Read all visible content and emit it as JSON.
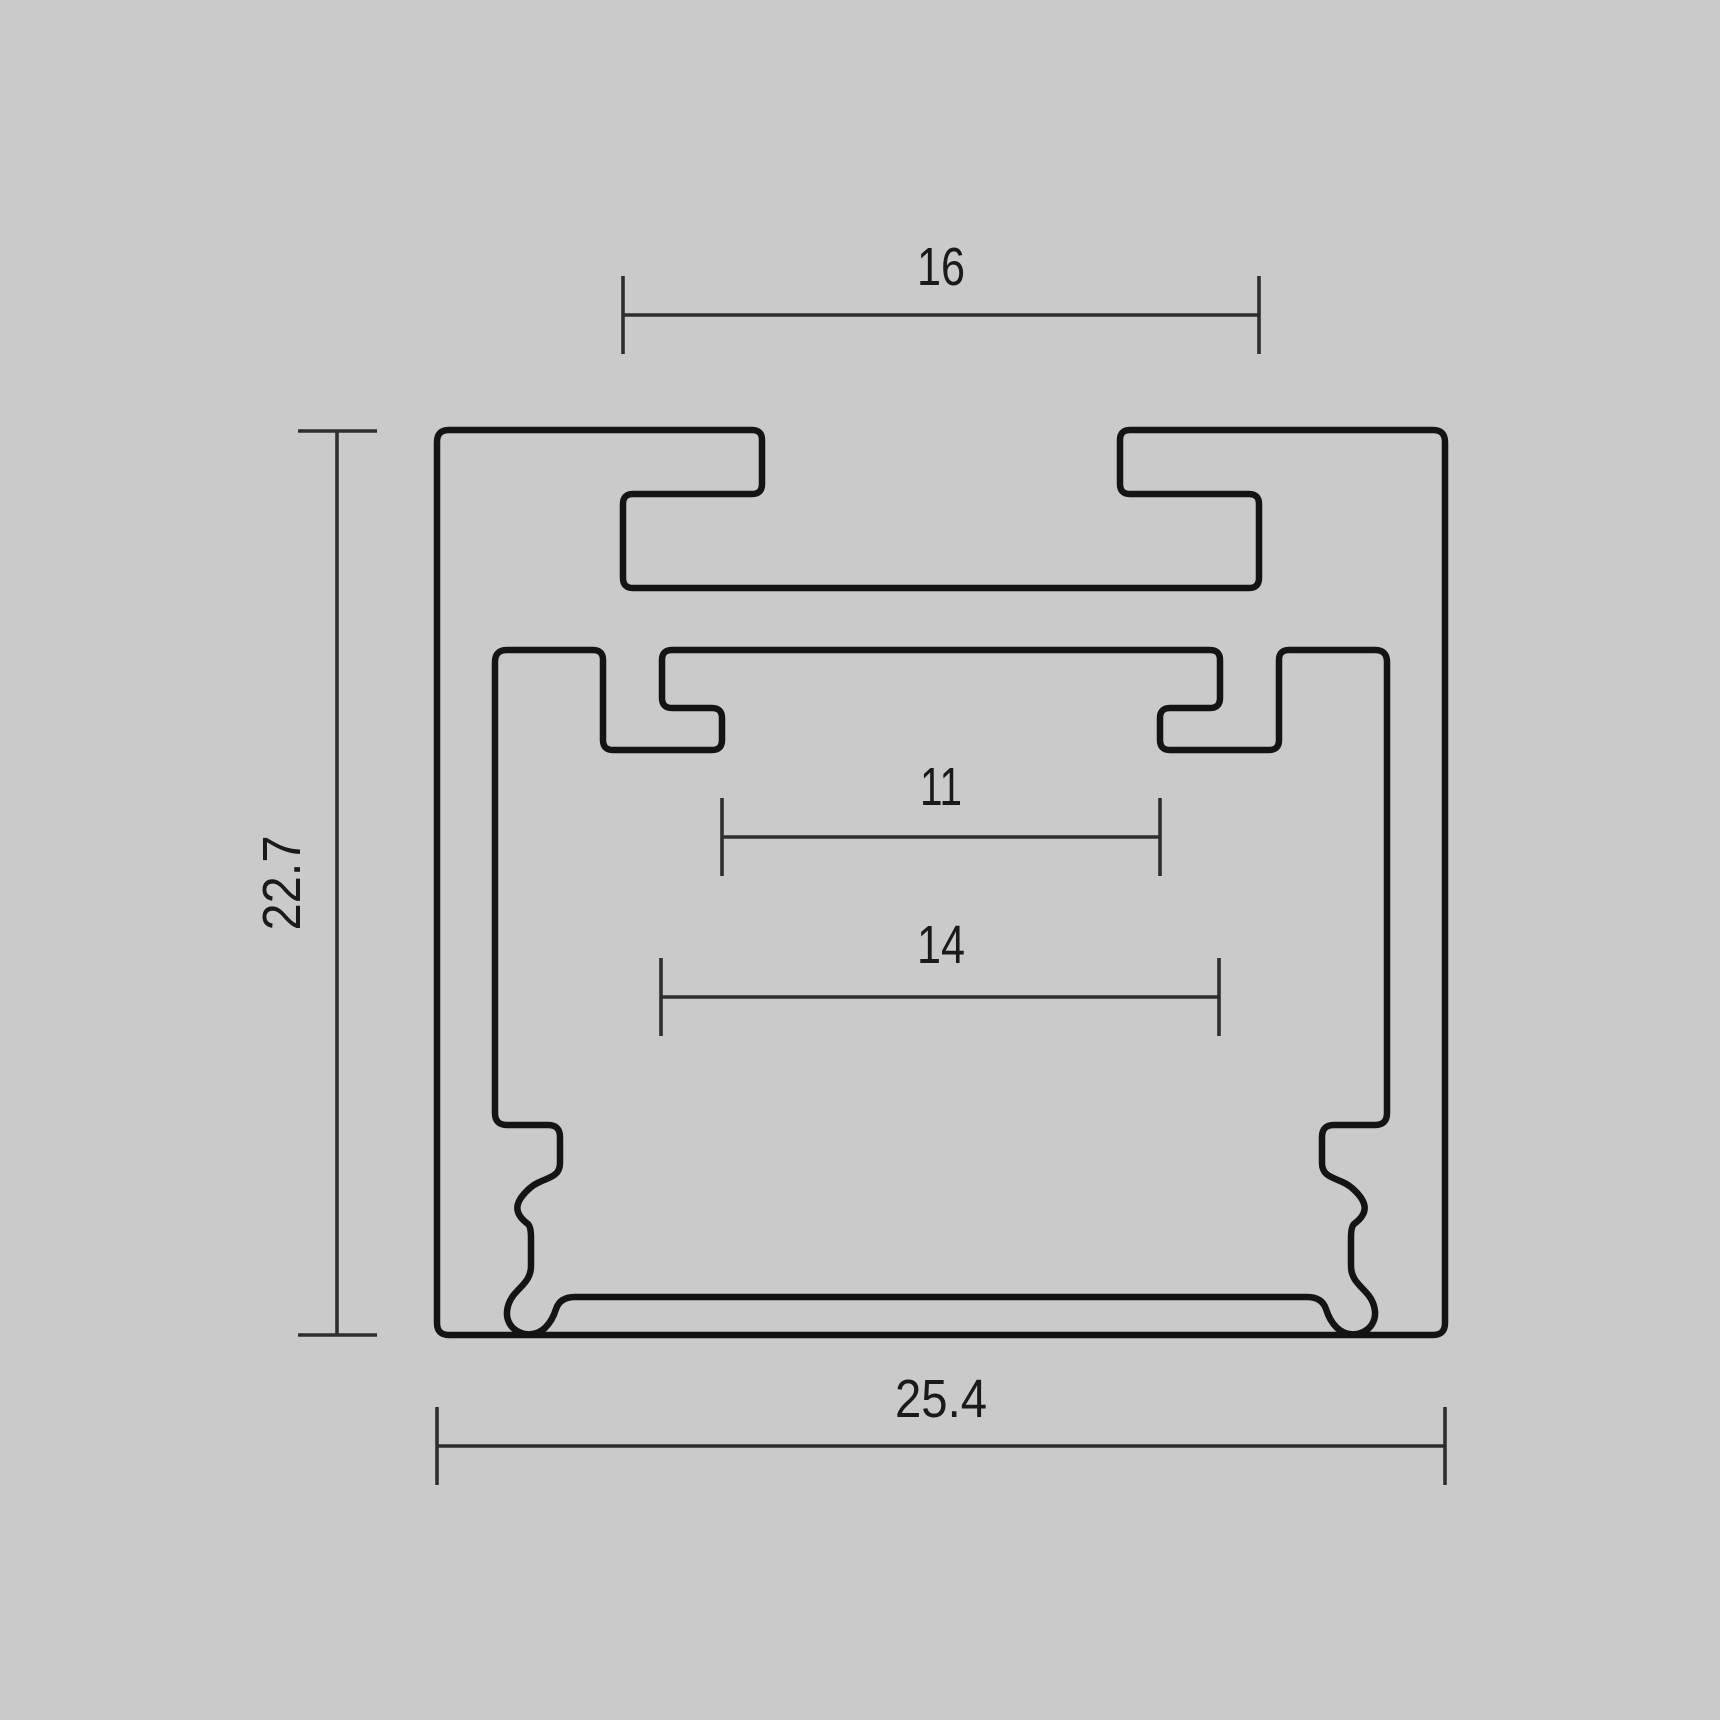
{
  "page": {
    "background_color": "#cacaca"
  },
  "drawing": {
    "type": "technical-cross-section-diagram",
    "outline_color": "#141414",
    "dimension_color": "#2e2e2e",
    "dimensions": {
      "slot_width": {
        "label": "16",
        "value": 16
      },
      "overall_height": {
        "label": "22.7",
        "value": 22.7
      },
      "clip_tip_width": {
        "label": "11",
        "value": 11
      },
      "clip_base_width": {
        "label": "14",
        "value": 14
      },
      "overall_width": {
        "label": "25.4",
        "value": 25.4
      }
    }
  }
}
